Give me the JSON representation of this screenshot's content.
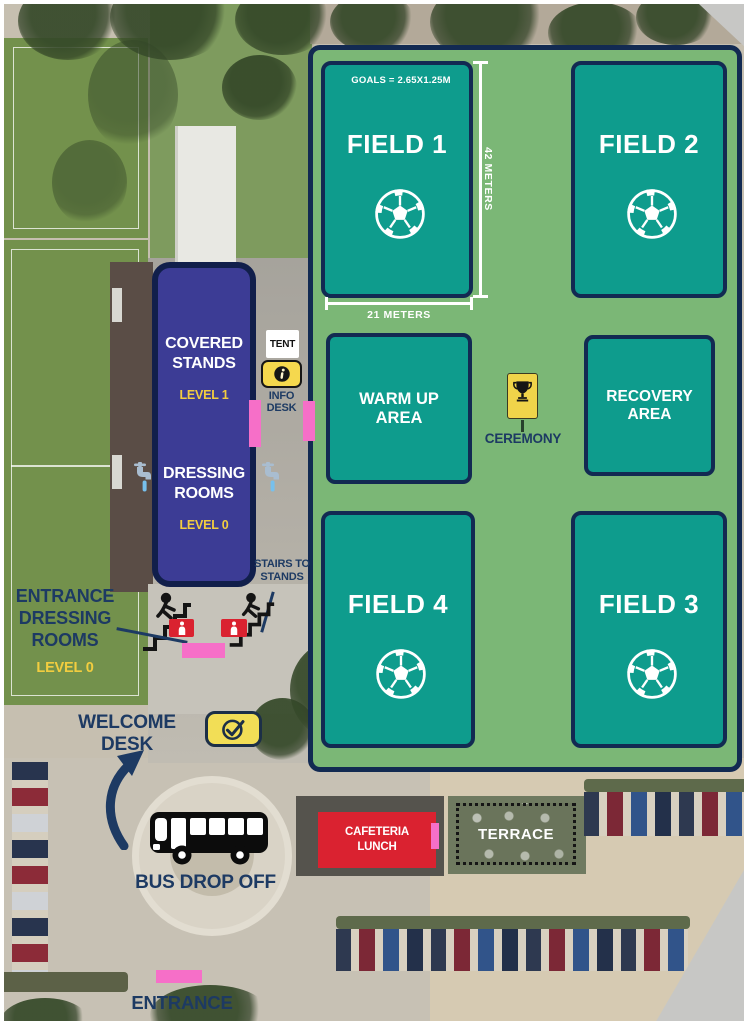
{
  "venue": {
    "fields": [
      {
        "name": "FIELD 1"
      },
      {
        "name": "FIELD 2"
      },
      {
        "name": "FIELD 4"
      },
      {
        "name": "FIELD 3"
      }
    ],
    "dimensions": {
      "goals_note": "GOALS = 2.65X1.25M",
      "length": "42 METERS",
      "width": "21 METERS"
    },
    "zones": {
      "warm_up": "WARM UP\nAREA",
      "recovery": "RECOVERY\nAREA",
      "ceremony": "CEREMONY"
    },
    "stands_building": {
      "covered_stands": "COVERED\nSTANDS",
      "covered_stands_level": "LEVEL 1",
      "dressing_rooms": "DRESSING\nROOMS",
      "dressing_rooms_level": "LEVEL 0"
    },
    "annotations": {
      "tent": "TENT",
      "info_desk": "INFO\nDESK",
      "stairs_to_stands": "STAIRS TO\nSTANDS",
      "entrance_dressing_rooms": "ENTRANCE\nDRESSING\nROOMS",
      "entrance_dressing_level": "LEVEL 0",
      "welcome_desk": "WELCOME DESK",
      "bus_drop_off": "BUS DROP OFF",
      "cafeteria": "CAFETERIA\nLUNCH",
      "terrace": "TERRACE",
      "entrance": "ENTRANCE"
    },
    "icons": {
      "soccer_ball": "⚽",
      "trophy": "🏆",
      "info": "ⓘ",
      "faucet": "🚰",
      "wc_person": "🚻",
      "stairs_person": "🚶",
      "check": "✓",
      "bus": "🚌",
      "curved_arrow": "➤",
      "pink_marker": "▮"
    },
    "colors": {
      "map_green": "#7bb776",
      "field_teal": "#0e9c8d",
      "border_navy": "#122a52",
      "text_navy": "#1d3a63",
      "stands_indigo": "#3c3c95",
      "level_yellow": "#f2cd3f",
      "badge_yellow": "#f5d84e",
      "marker_pink": "#f66fc8",
      "alert_red": "#da2230",
      "icon_black": "#141414"
    }
  }
}
